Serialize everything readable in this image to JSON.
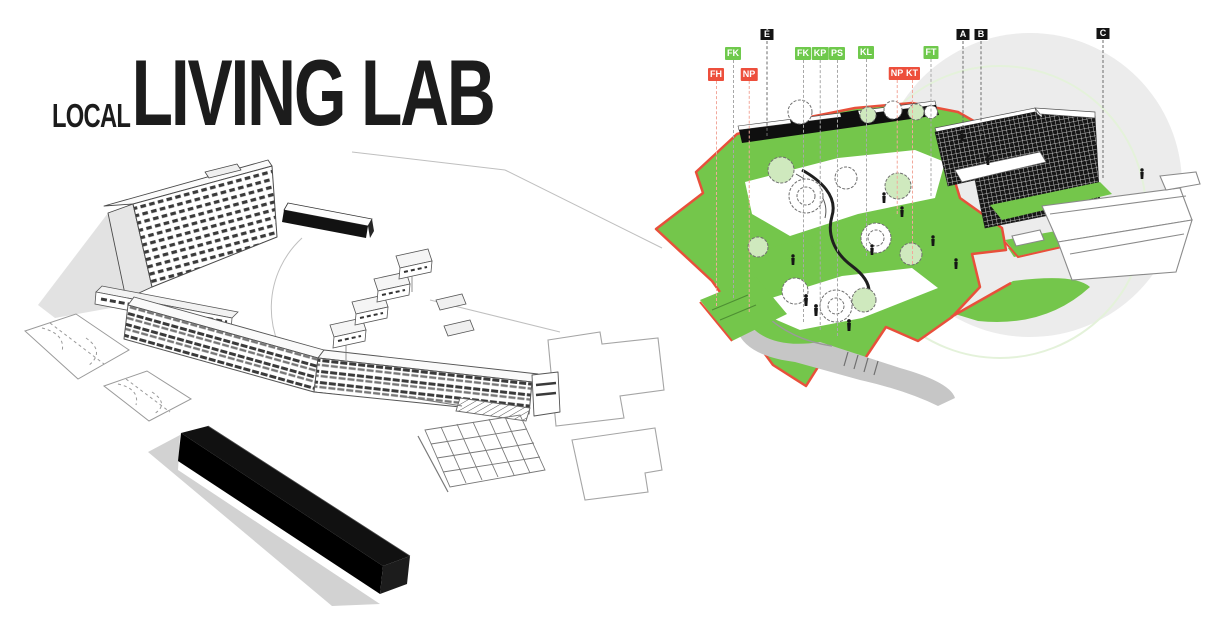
{
  "title": {
    "prefix": "LOCAL",
    "main": "LIVING LAB"
  },
  "colors": {
    "site-green": "#74C64B",
    "foliage-green": "#CFE9BE",
    "pale-green": "#E4F2DA",
    "accent-red": "#E8503B",
    "leader-red": "#F2A89B",
    "marker-green": "#6FC94C",
    "marker-red": "#ED4F3C",
    "marker-black": "#141414",
    "leader-gray": "#A8A8A8",
    "leader-dark": "#6B6B6B",
    "ink": "#444444",
    "shadow-gray": "#D8D8D8",
    "path-gray": "#C6C6C6",
    "backdrop-gray": "#ECECEC"
  },
  "markers": [
    {
      "label": "FH",
      "type": "red",
      "x": 716,
      "y": 68,
      "line_to": 306
    },
    {
      "label": "FK",
      "type": "green",
      "x": 733,
      "y": 47,
      "line_to": 298
    },
    {
      "label": "NP",
      "type": "red",
      "x": 749,
      "y": 68,
      "line_to": 312
    },
    {
      "label": "É",
      "type": "black",
      "x": 767,
      "y": 28,
      "line_to": 136
    },
    {
      "label": "FK",
      "type": "green",
      "x": 803,
      "y": 47,
      "line_to": 322
    },
    {
      "label": "KP",
      "type": "green",
      "x": 820,
      "y": 47,
      "line_to": 330
    },
    {
      "label": "PS",
      "type": "green",
      "x": 837,
      "y": 47,
      "line_to": 336
    },
    {
      "label": "KL",
      "type": "green",
      "x": 866,
      "y": 46,
      "line_to": 256
    },
    {
      "label": "NP",
      "type": "red",
      "x": 897,
      "y": 67,
      "line_to": 214
    },
    {
      "label": "KT",
      "type": "red",
      "x": 912,
      "y": 67,
      "line_to": 264
    },
    {
      "label": "FT",
      "type": "green",
      "x": 931,
      "y": 46,
      "line_to": 196
    },
    {
      "label": "A",
      "type": "black",
      "x": 963,
      "y": 28,
      "line_to": 128
    },
    {
      "label": "B",
      "type": "black",
      "x": 981,
      "y": 28,
      "line_to": 136
    },
    {
      "label": "C",
      "type": "black",
      "x": 1103,
      "y": 27,
      "line_to": 178
    }
  ]
}
